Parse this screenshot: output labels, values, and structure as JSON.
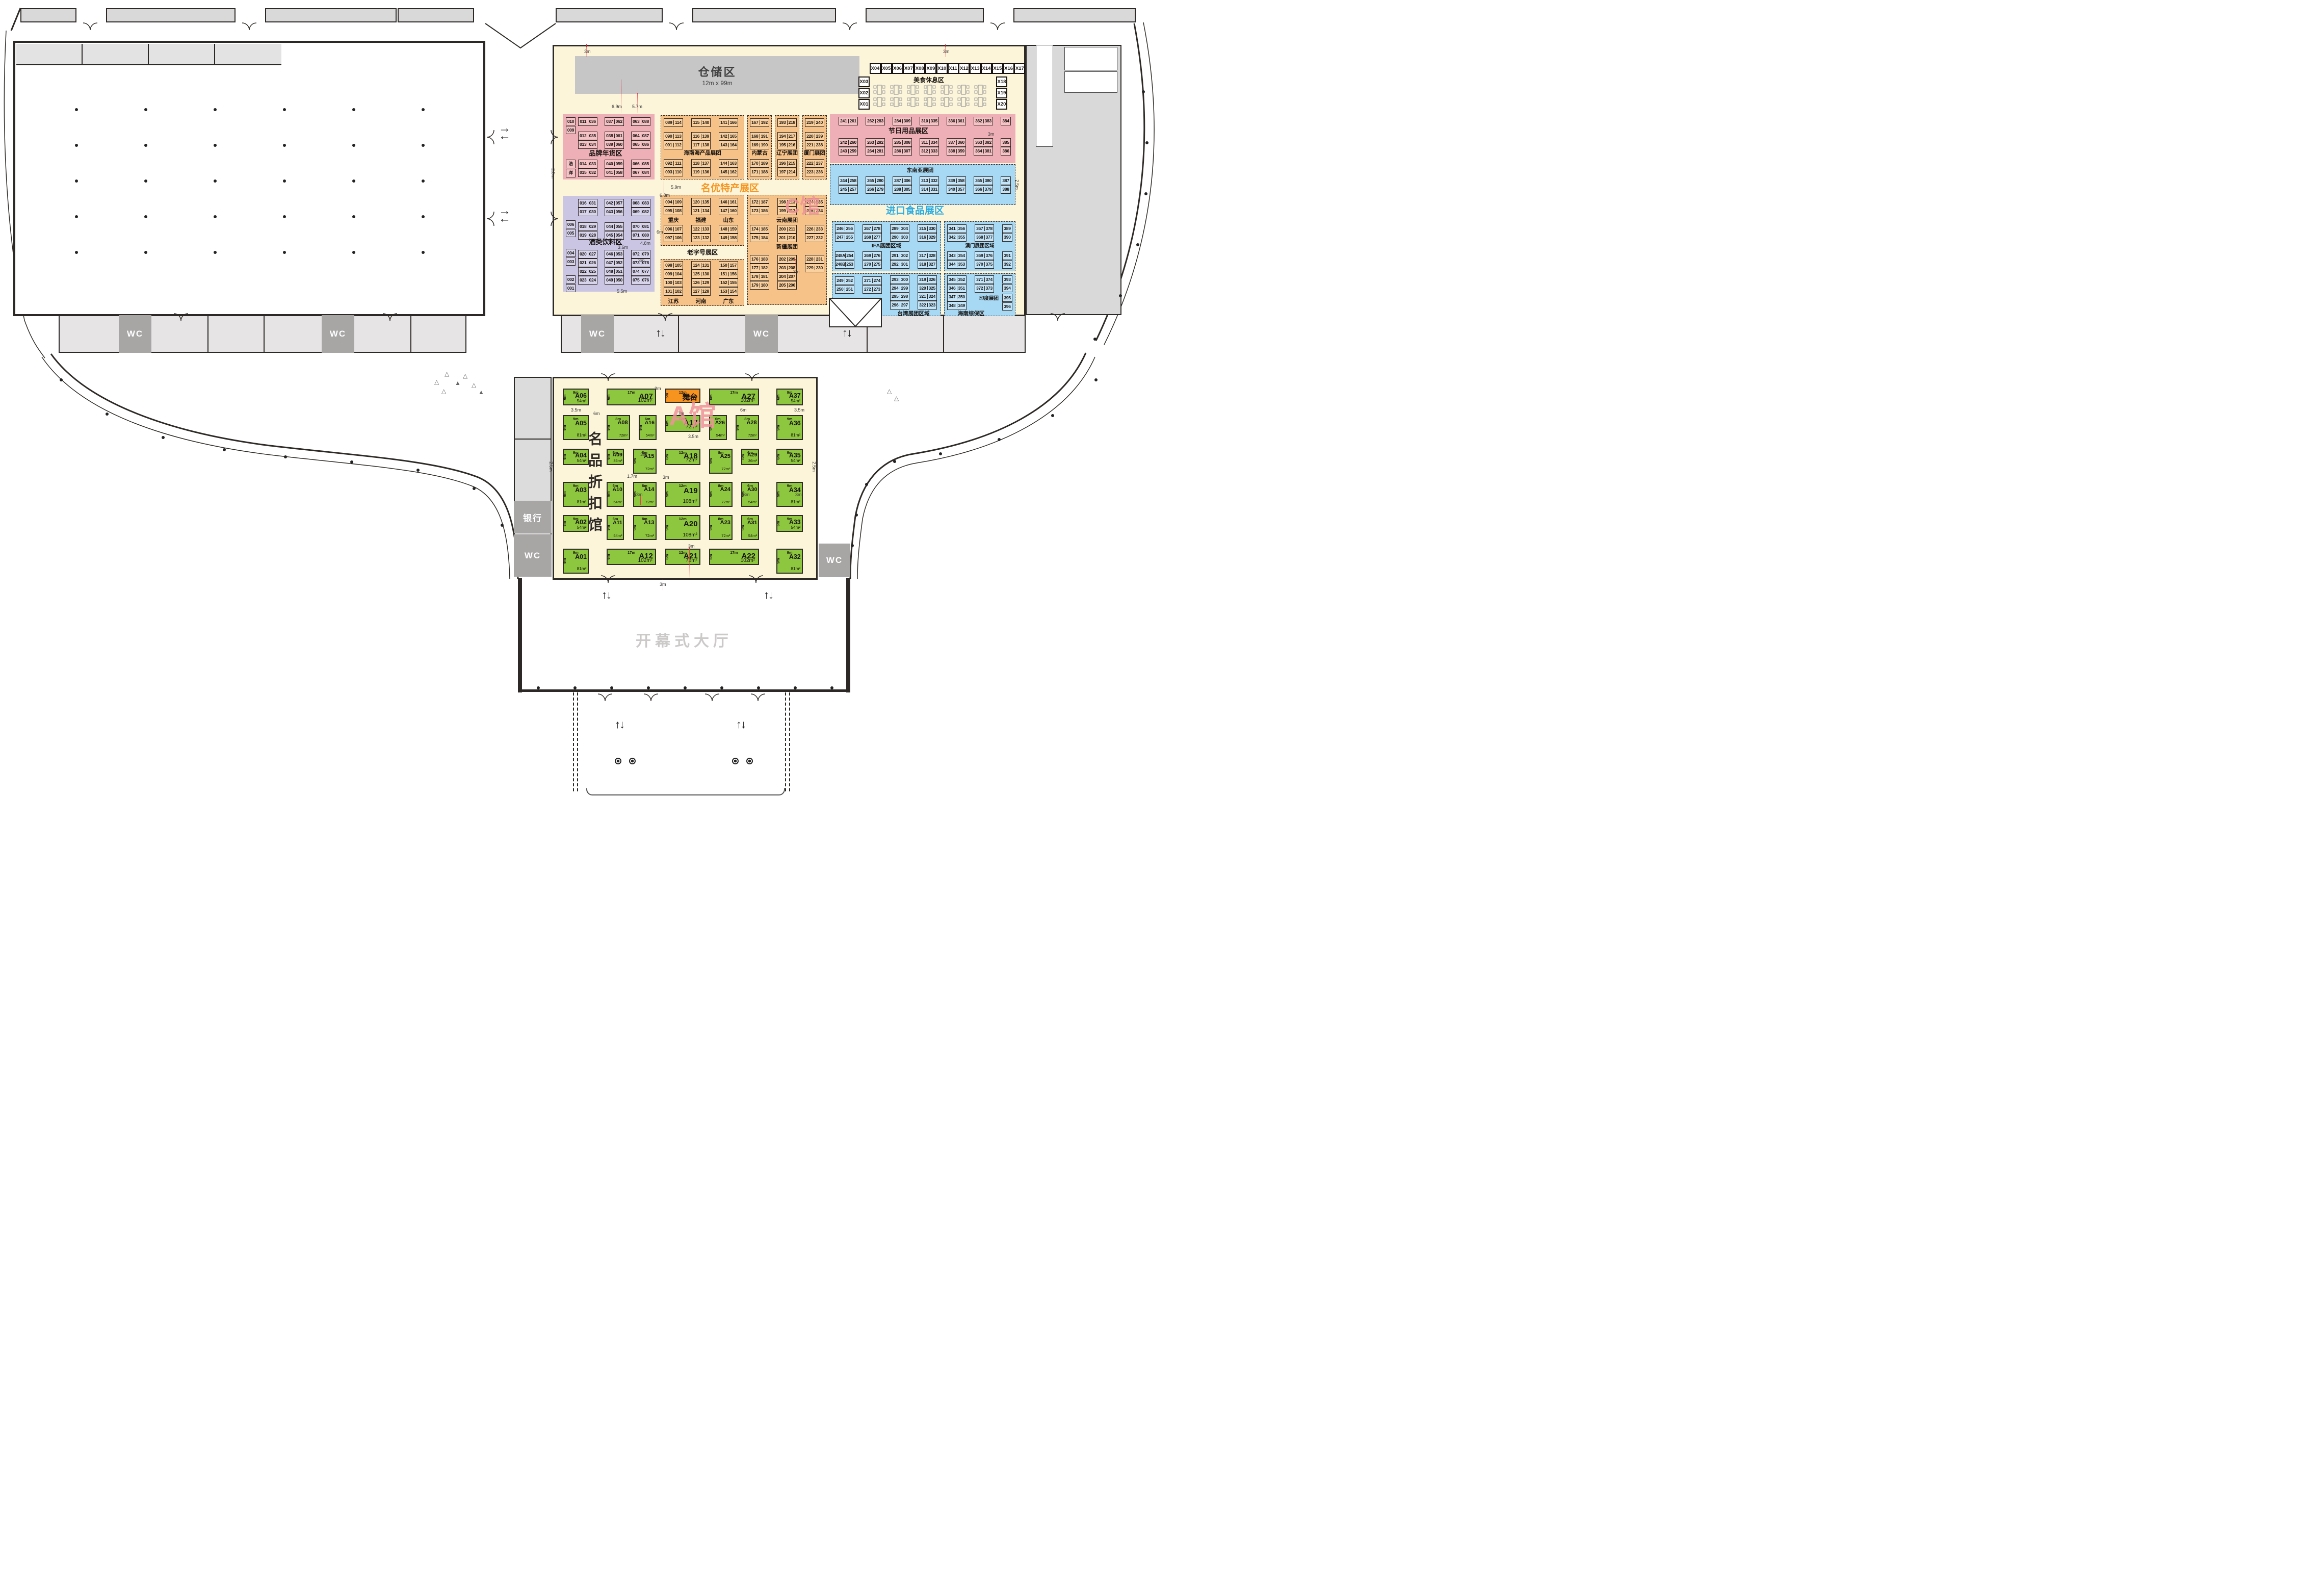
{
  "c_hall": {
    "hall_label": "C馆",
    "storage": {
      "label": "仓储区",
      "size": "12m x 99m"
    },
    "food_rest": {
      "label": "美食休息区",
      "x_top": [
        "X04",
        "X05",
        "X06",
        "X07",
        "X08",
        "X09",
        "X10",
        "X11",
        "X12",
        "X13",
        "X14",
        "X15",
        "X16",
        "X17"
      ],
      "x_left": [
        "X03",
        "X02",
        "X01"
      ],
      "x_right": [
        "X18",
        "X19",
        "X20"
      ]
    },
    "brand_zone": {
      "label": "品牌年货区",
      "corner": [
        "010",
        "009"
      ],
      "sponsor": [
        "浩",
        "洋"
      ],
      "cols": [
        {
          "top": [
            "011|036"
          ],
          "mid": [
            "012|035",
            "013|034"
          ],
          "bot": [
            "014|033",
            "015|032"
          ]
        },
        {
          "top": [
            "037|062"
          ],
          "mid": [
            "038|061",
            "039|060"
          ],
          "bot": [
            "040|059",
            "041|058"
          ]
        },
        {
          "top": [
            "063|088"
          ],
          "mid": [
            "064|087",
            "065|086"
          ],
          "bot": [
            "066|085",
            "067|084"
          ]
        }
      ]
    },
    "wine_zone": {
      "label": "酒类饮料区",
      "side": [
        "006",
        "005",
        "004",
        "003",
        "002",
        "001"
      ],
      "cols": [
        {
          "top": [
            "016|031",
            "017|030"
          ],
          "mid": [
            "018|029",
            "019|028"
          ],
          "bot": [
            "020|027",
            "021|026",
            "022|025",
            "023|024"
          ]
        },
        {
          "top": [
            "042|057",
            "043|056"
          ],
          "mid": [
            "044|055",
            "045|054"
          ],
          "bot": [
            "046|053",
            "047|052",
            "048|051",
            "049|050"
          ]
        },
        {
          "top": [
            "068|083",
            "069|082"
          ],
          "mid": [
            "070|081",
            "071|080"
          ],
          "bot": [
            "072|079",
            "073|078",
            "074|077",
            "075|076"
          ]
        }
      ]
    },
    "specialty": {
      "title": "名优特产展区",
      "heritage_label": "老字号展区",
      "upper_groups": [
        {
          "label": "海南海产品展团",
          "cols": [
            {
              "top": [
                "089|114"
              ],
              "mid": [
                "090|113",
                "091|112"
              ],
              "bot": [
                "092|111",
                "093|110"
              ]
            },
            {
              "top": [
                "115|140"
              ],
              "mid": [
                "116|139",
                "117|138"
              ],
              "bot": [
                "118|137",
                "119|136"
              ]
            },
            {
              "top": [
                "141|166"
              ],
              "mid": [
                "142|165",
                "143|164"
              ],
              "bot": [
                "144|163",
                "145|162"
              ]
            }
          ]
        },
        {
          "label": "内蒙古",
          "cols": [
            {
              "top": [
                "167|192"
              ],
              "mid": [
                "168|191",
                "169|190"
              ],
              "bot": [
                "170|189",
                "171|188"
              ]
            }
          ]
        },
        {
          "label": "辽宁展团",
          "cols": [
            {
              "top": [
                "193|218"
              ],
              "mid": [
                "194|217",
                "195|216"
              ],
              "bot": [
                "196|215",
                "197|214"
              ]
            }
          ]
        },
        {
          "label": "厦门展团",
          "cols": [
            {
              "top": [
                "219|240"
              ],
              "mid": [
                "220|239",
                "221|238"
              ],
              "bot": [
                "222|237",
                "223|236"
              ]
            }
          ]
        }
      ],
      "mid_left": {
        "labels": [
          "重庆",
          "福建",
          "山东"
        ],
        "cols": [
          {
            "top": [
              "094|109",
              "095|108"
            ],
            "bot": [
              "096|107",
              "097|106"
            ]
          },
          {
            "top": [
              "120|135",
              "121|134"
            ],
            "bot": [
              "122|133",
              "123|132"
            ]
          },
          {
            "top": [
              "146|161",
              "147|160"
            ],
            "bot": [
              "148|159",
              "149|158"
            ]
          }
        ]
      },
      "mid_right": {
        "label_top": "云南展团",
        "label_bot": "新疆展团",
        "cols": [
          {
            "top": [
              "172|187",
              "173|186"
            ],
            "bot": [
              "174|185",
              "175|184"
            ]
          },
          {
            "top": [
              "198|213",
              "199|212"
            ],
            "bot": [
              "200|211",
              "201|210"
            ]
          },
          {
            "top": [
              "224|235",
              "225|234"
            ],
            "bot": [
              "226|233",
              "227|232"
            ]
          }
        ]
      },
      "lower_left": {
        "labels": [
          "江苏",
          "河南",
          "广东"
        ],
        "cols": [
          [
            "098|105",
            "099|104",
            "100|103",
            "101|102"
          ],
          [
            "124|131",
            "125|130",
            "126|129",
            "127|128"
          ],
          [
            "150|157",
            "151|156",
            "152|155",
            "153|154"
          ]
        ]
      },
      "lower_right": {
        "cols": [
          [
            "176|183",
            "177|182",
            "178|181",
            "179|180"
          ],
          [
            "202|209",
            "203|208",
            "204|207",
            "205|206"
          ],
          [
            "228|231",
            "229|230"
          ]
        ]
      }
    },
    "festival_zone": {
      "label": "节日用品展区",
      "row1": [
        "241|261",
        "262|283",
        "284|309",
        "310|335",
        "336|361",
        "362|383"
      ],
      "row1_single": "384",
      "row2": [
        [
          "242|260",
          "243|259"
        ],
        [
          "263|282",
          "264|281"
        ],
        [
          "285|308",
          "286|307"
        ],
        [
          "311|334",
          "312|333"
        ],
        [
          "337|360",
          "338|359"
        ],
        [
          "363|382",
          "364|381"
        ]
      ],
      "row2_singles": [
        "385",
        "386"
      ]
    },
    "sea_group": {
      "label": "东南亚展团",
      "pairs": [
        [
          "244|258",
          "245|257"
        ],
        [
          "265|280",
          "266|279"
        ],
        [
          "287|306",
          "288|305"
        ],
        [
          "313|332",
          "314|331"
        ],
        [
          "339|358",
          "340|357"
        ],
        [
          "365|380",
          "366|379"
        ]
      ],
      "singles": [
        "387",
        "388"
      ]
    },
    "import_zone": {
      "title": "进口食品展区",
      "ifa": {
        "label": "IFA展团区域",
        "row1": [
          [
            "246|256",
            "247|255"
          ],
          [
            "267|278",
            "268|277"
          ],
          [
            "289|304",
            "290|303"
          ],
          [
            "315|330",
            "316|329"
          ]
        ],
        "row2": [
          [
            "248A|254",
            "248B|253"
          ],
          [
            "269|276",
            "270|275"
          ],
          [
            "291|302",
            "292|301"
          ],
          [
            "317|328",
            "318|327"
          ]
        ]
      },
      "macau": {
        "label": "澳门展团区域",
        "row1": [
          [
            "341|356",
            "342|355"
          ],
          [
            "367|378",
            "368|377"
          ]
        ],
        "row1_singles": [
          "389",
          "390"
        ],
        "row2": [
          [
            "343|354",
            "344|353"
          ],
          [
            "369|376",
            "370|375"
          ]
        ],
        "row2_singles": [
          "391",
          "392"
        ]
      },
      "taiwan": {
        "label": "台湾展团区域",
        "two_row": [
          [
            "249|252",
            "250|251"
          ],
          [
            "271|274",
            "272|273"
          ]
        ],
        "four_row": [
          [
            "293|300",
            "294|299",
            "295|298",
            "296|297"
          ],
          [
            "319|326",
            "320|325",
            "321|324",
            "322|323"
          ]
        ]
      },
      "right_low": {
        "label": "海南综保区",
        "india": "印度展团",
        "four_row": [
          "345|352",
          "346|351",
          "347|350",
          "348|349"
        ],
        "two_row": [
          "371|374",
          "372|373"
        ],
        "singles": [
          "393",
          "394",
          "395",
          "396"
        ]
      }
    }
  },
  "a_hall": {
    "hall_label": "A馆",
    "name_title": "名品折扣馆",
    "stage": {
      "label": "舞台",
      "area": "60m²",
      "w": "12m",
      "h": "5m"
    },
    "booths": [
      {
        "id": "A01",
        "w": "9m",
        "h": "9m",
        "area": "81m²"
      },
      {
        "id": "A02",
        "w": "9m",
        "h": "6m",
        "area": "54m²"
      },
      {
        "id": "A03",
        "w": "9m",
        "h": "9m",
        "area": "81m²"
      },
      {
        "id": "A04",
        "w": "9m",
        "h": "6m",
        "area": "54m²"
      },
      {
        "id": "A05",
        "w": "9m",
        "h": "9m",
        "area": "81m²"
      },
      {
        "id": "A06",
        "w": "9m",
        "h": "6m",
        "area": "54m²"
      },
      {
        "id": "A07",
        "w": "17m",
        "h": "6m",
        "area": "102m²"
      },
      {
        "id": "A08",
        "w": "8m",
        "h": "9m",
        "area": "72m²"
      },
      {
        "id": "A09",
        "w": "6m",
        "h": "6m",
        "area": "36m²"
      },
      {
        "id": "A10",
        "w": "6m",
        "h": "9m",
        "area": "54m²"
      },
      {
        "id": "A11",
        "w": "6m",
        "h": "9m",
        "area": "54m²"
      },
      {
        "id": "A12",
        "w": "17m",
        "h": "6m",
        "area": "102m²"
      },
      {
        "id": "A13",
        "w": "8m",
        "h": "9m",
        "area": "72m²"
      },
      {
        "id": "A14",
        "w": "8m",
        "h": "9m",
        "area": "72m²"
      },
      {
        "id": "A15",
        "w": "8m",
        "h": "9m",
        "area": "72m²"
      },
      {
        "id": "A16",
        "w": "6m",
        "h": "9m",
        "area": "54m²"
      },
      {
        "id": "A17",
        "w": "12m",
        "h": "6m",
        "area": "72m²"
      },
      {
        "id": "A18",
        "w": "12m",
        "h": "6m",
        "area": "72m²"
      },
      {
        "id": "A19",
        "w": "12m",
        "h": "9m",
        "area": "108m²"
      },
      {
        "id": "A20",
        "w": "12m",
        "h": "9m",
        "area": "108m²"
      },
      {
        "id": "A21",
        "w": "12m",
        "h": "6m",
        "area": "72m²"
      },
      {
        "id": "A22",
        "w": "17m",
        "h": "6m",
        "area": "102m²"
      },
      {
        "id": "A23",
        "w": "8m",
        "h": "9m",
        "area": "72m²"
      },
      {
        "id": "A24",
        "w": "8m",
        "h": "9m",
        "area": "72m²"
      },
      {
        "id": "A25",
        "w": "8m",
        "h": "9m",
        "area": "72m²"
      },
      {
        "id": "A26",
        "w": "6m",
        "h": "9m",
        "area": "54m²"
      },
      {
        "id": "A27",
        "w": "17m",
        "h": "6m",
        "area": "102m²"
      },
      {
        "id": "A28",
        "w": "8m",
        "h": "9m",
        "area": "72m²"
      },
      {
        "id": "A29",
        "w": "6m",
        "h": "6m",
        "area": "36m²"
      },
      {
        "id": "A30",
        "w": "6m",
        "h": "9m",
        "area": "54m²"
      },
      {
        "id": "A31",
        "w": "6m",
        "h": "9m",
        "area": "54m²"
      },
      {
        "id": "A32",
        "w": "9m",
        "h": "9m",
        "area": "81m²"
      },
      {
        "id": "A33",
        "w": "9m",
        "h": "6m",
        "area": "54m²"
      },
      {
        "id": "A34",
        "w": "9m",
        "h": "9m",
        "area": "81m²"
      },
      {
        "id": "A35",
        "w": "9m",
        "h": "6m",
        "area": "54m²"
      },
      {
        "id": "A36",
        "w": "9m",
        "h": "9m",
        "area": "81m²"
      },
      {
        "id": "A37",
        "w": "9m",
        "h": "6m",
        "area": "54m²"
      }
    ]
  },
  "facilities": {
    "wc": "WC",
    "bank": "银行",
    "opening_hall": "开幕式大厅"
  },
  "dims": [
    "3m",
    "3m",
    "6.9m",
    "5.7m",
    "5.9m",
    "6.8m",
    "3.6m",
    "4.8m",
    "6m",
    "3m",
    "5.5m",
    "2.5m",
    "2.5m",
    "3m",
    "3m",
    "3m",
    "3.5m",
    "6m",
    "6m",
    "3.5m",
    "7m",
    "3.5m",
    "3m",
    "1.7m",
    "3m",
    "3m",
    "3m",
    "3m",
    "3m",
    "3m",
    "2.5m",
    "2.5m"
  ]
}
